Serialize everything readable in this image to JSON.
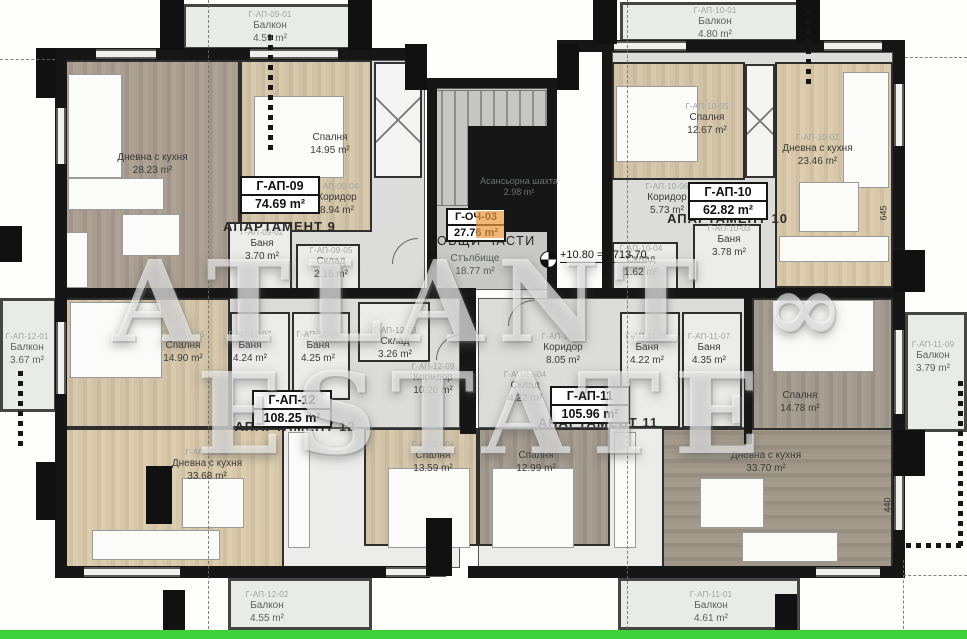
{
  "watermark": {
    "left": "ATLANT",
    "symbol": "∞",
    "right": "ESTATE"
  },
  "elevation": {
    "text": "+10.80 = +713.70"
  },
  "dimensions": {
    "right_upper": "645",
    "right_lower": "440"
  },
  "colors": {
    "bottom_line": "#3ed13b",
    "wall": "#161616",
    "highlight_orange": "#e9983c"
  },
  "common": {
    "box_code": "Г-ОЧ-03",
    "box_area": "27.76 m²",
    "title": "ОБЩИ ЧАСТИ",
    "stairs_name": "Стълбище",
    "stairs_area": "18.77 m²",
    "elevator_name": "Асансьорна шахта",
    "elevator_area": "2.98 m²"
  },
  "apartments": [
    {
      "code": "Г-АП-09",
      "area": "74.69 m²",
      "label": "АПАРТАМЕНТ 9",
      "rooms": [
        {
          "code": "Г-АП-09-01",
          "name": "Балкон",
          "area": "4.59 m²"
        },
        {
          "name": "Дневна с кухня",
          "area": "28.23 m²"
        },
        {
          "name": "Спалня",
          "area": "14.95 m²"
        },
        {
          "code": "Г-АП-09-04",
          "name": "Коридор",
          "area": "8.94 m²"
        },
        {
          "code": "Г-АП-09-02",
          "name": "Баня",
          "area": "3.70 m²"
        },
        {
          "code": "Г-АП-09-05",
          "name": "Склад",
          "area": "2.16 m²"
        }
      ]
    },
    {
      "code": "Г-АП-10",
      "area": "62.82 m²",
      "label": "АПАРТАМЕНТ 10",
      "rooms": [
        {
          "code": "Г-АП-10-01",
          "name": "Балкон",
          "area": "4.80 m²"
        },
        {
          "code": "Г-АП-10-05",
          "name": "Спалня",
          "area": "12.67 m²"
        },
        {
          "code": "Г-АП-10-02",
          "name": "Дневна с кухня",
          "area": "23.46 m²"
        },
        {
          "code": "Г-АП-10-06",
          "name": "Коридор",
          "area": "5.73 m²"
        },
        {
          "code": "Г-АП-10-03",
          "name": "Баня",
          "area": "3.78 m²"
        },
        {
          "code": "Г-АП-10-04",
          "name": "Склад",
          "area": "1.62 m²"
        }
      ]
    },
    {
      "code": "Г-АП-12",
      "area": "108.25 m²",
      "label": "АПАРТАМЕНТ 12",
      "rooms": [
        {
          "code": "Г-АП-12-01",
          "name": "Балкон",
          "area": "3.67 m²"
        },
        {
          "code": "Г-АП-12-06",
          "name": "Спалня",
          "area": "14.90 m²"
        },
        {
          "code": "Г-АП-12-07",
          "name": "Баня",
          "area": "4.24 m²"
        },
        {
          "code": "Г-АП-12-08",
          "name": "Баня",
          "area": "4.25 m²"
        },
        {
          "code": "Г-АП-12-03",
          "name": "Склад",
          "area": "3.26 m²"
        },
        {
          "code": "Г-АП-12-09",
          "name": "Коридор",
          "area": "10.20 m²"
        },
        {
          "code": "Г-АП-12-05",
          "name": "Дневна с кухня",
          "area": "33.68 m²"
        },
        {
          "code": "Г-АП-12-04",
          "name": "Спалня",
          "area": "13.59 m²"
        },
        {
          "code": "Г-АП-12-02",
          "name": "Балкон",
          "area": "4.55 m²"
        }
      ]
    },
    {
      "code": "Г-АП-11",
      "area": "105.96 m²",
      "label": "АПАРТАМЕНТ 11",
      "rooms": [
        {
          "code": "Г-АП-11-05",
          "name": "Коридор",
          "area": "8.05 m²"
        },
        {
          "code": "Г-АП-11-04",
          "name": "Склад",
          "area": "4.22 m²"
        },
        {
          "code": "Г-АП-11-06",
          "name": "Баня",
          "area": "4.22 m²"
        },
        {
          "code": "Г-АП-11-07",
          "name": "Баня",
          "area": "4.35 m²"
        },
        {
          "name": "Спалня",
          "area": "14.78 m²"
        },
        {
          "name": "Спалня",
          "area": "12.99 m²"
        },
        {
          "name": "Дневна с кухня",
          "area": "33.70 m²"
        },
        {
          "code": "Г-АП-11-01",
          "name": "Балкон",
          "area": "4.61 m²"
        },
        {
          "code": "Г-АП-11-09",
          "name": "Балкон",
          "area": "3.79 m²"
        }
      ]
    }
  ]
}
